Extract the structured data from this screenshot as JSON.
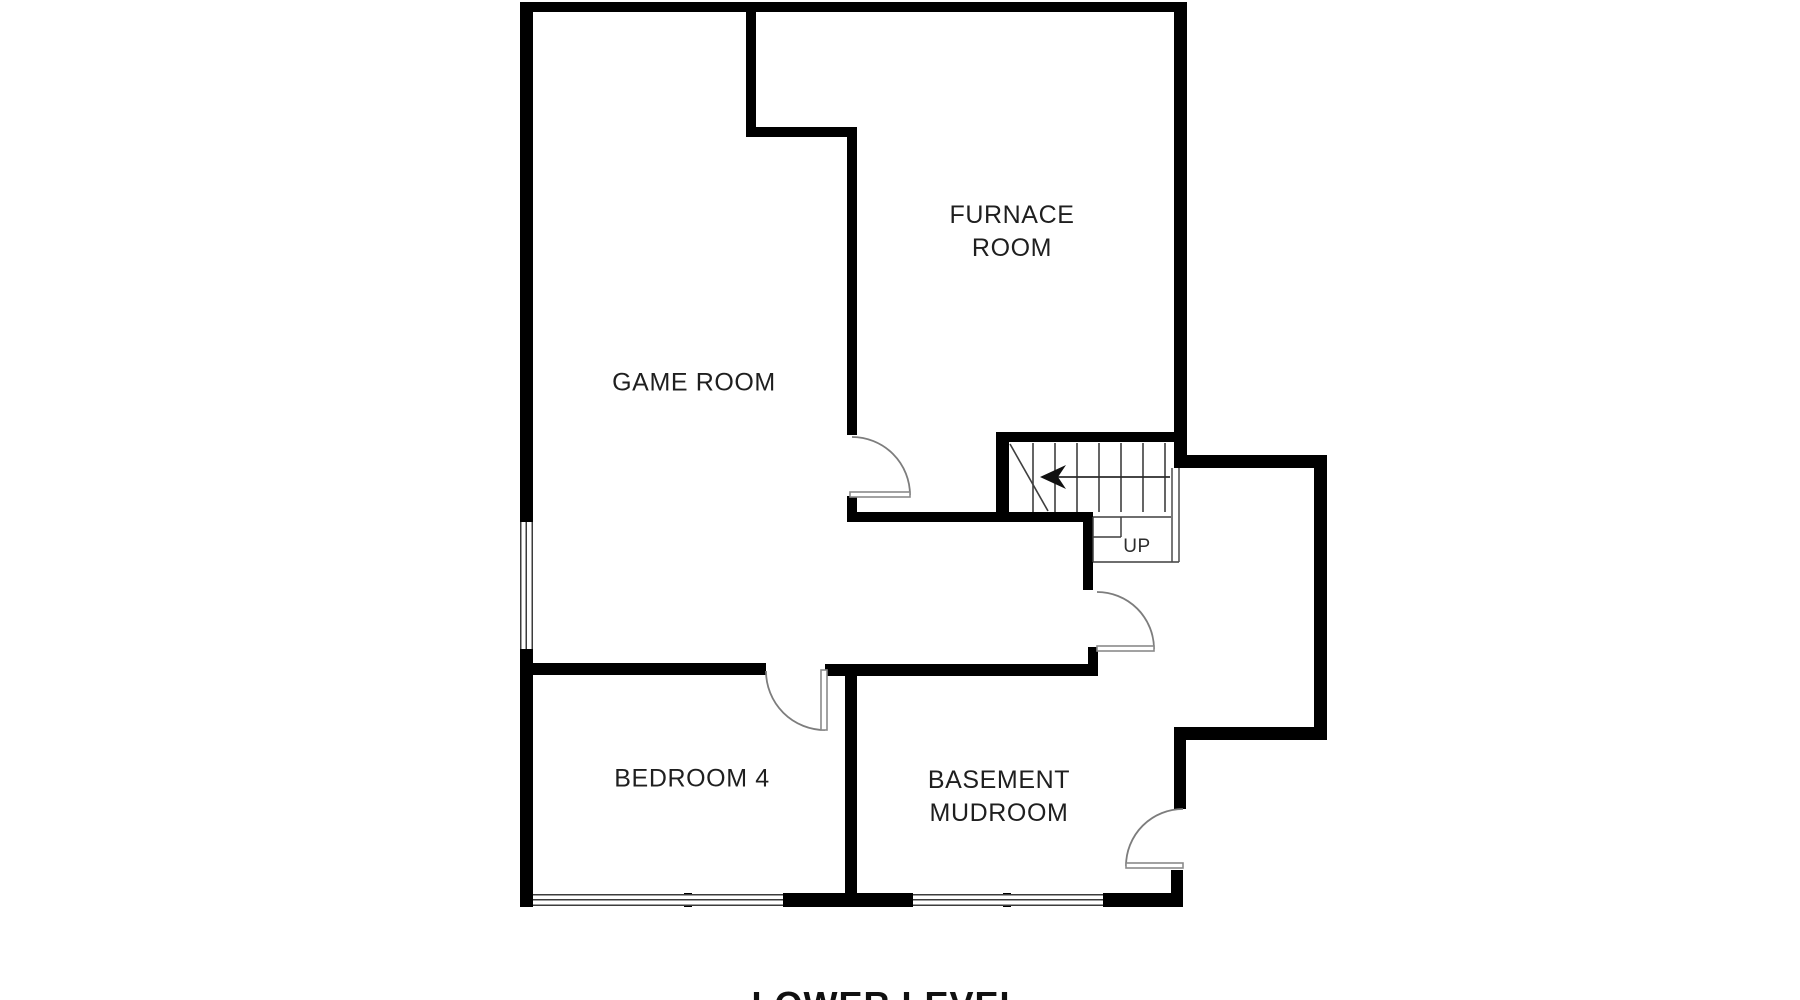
{
  "title": "LOWER LEVEL",
  "rooms": {
    "furnace": {
      "line1": "FURNACE",
      "line2": "ROOM"
    },
    "game": {
      "label": "GAME ROOM"
    },
    "bedroom4": {
      "label": "BEDROOM 4"
    },
    "mudroom": {
      "line1": "BASEMENT",
      "line2": "MUDROOM"
    }
  },
  "stairs": {
    "up_label": "UP",
    "direction_icon": "left-arrow-icon"
  },
  "colors": {
    "wall": "#000000",
    "text": "#1f1f1f",
    "door": "#8a8a8a",
    "stair_line": "#3f3f3f",
    "background": "#ffffff"
  }
}
